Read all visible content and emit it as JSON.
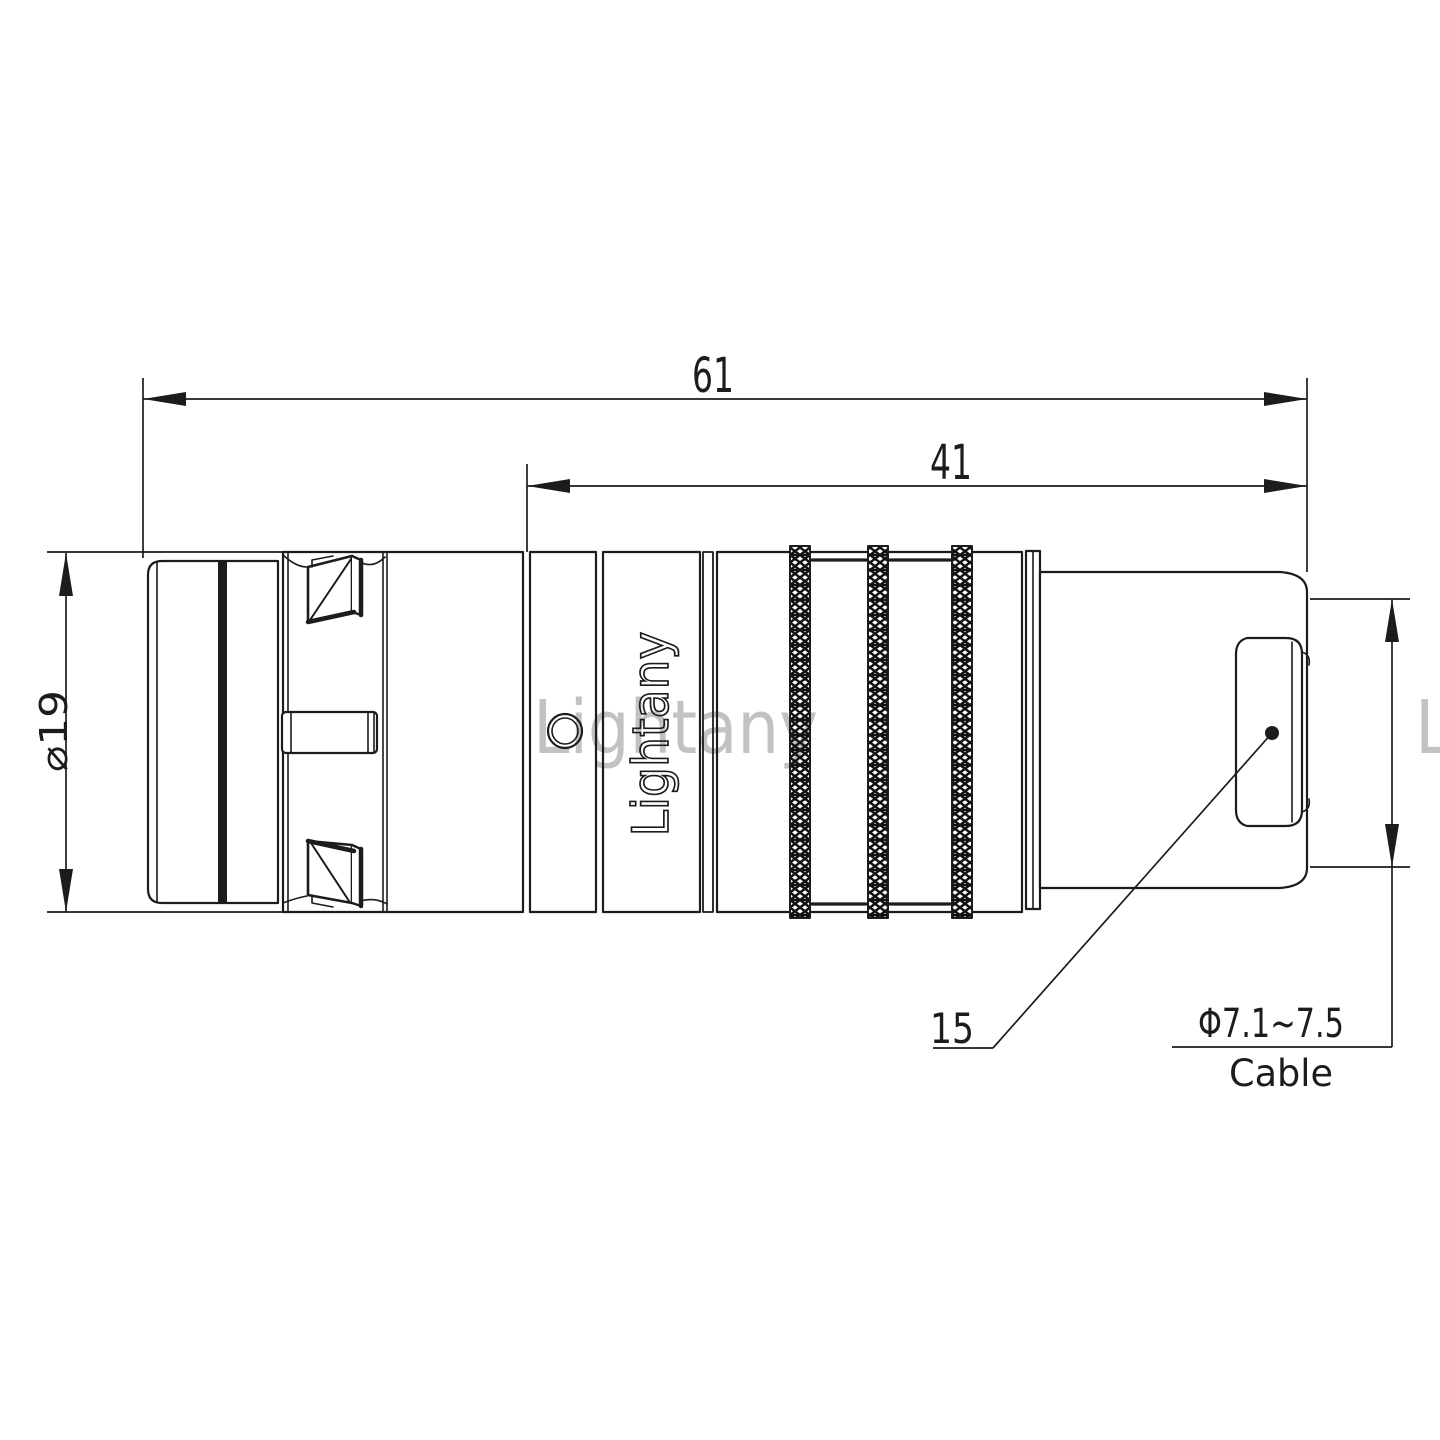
{
  "drawing": {
    "dim_total_length": "61",
    "dim_front_length": "41",
    "dim_diameter": "⌀19",
    "callout_position": "15",
    "cable_diameter_range": "Φ7.1~7.5",
    "cable_label": "Cable"
  },
  "branding": {
    "engraving": "Lightany",
    "watermark": "Lightany"
  },
  "colors": {
    "line": "#1c1c1c",
    "watermark": "#e06060"
  }
}
